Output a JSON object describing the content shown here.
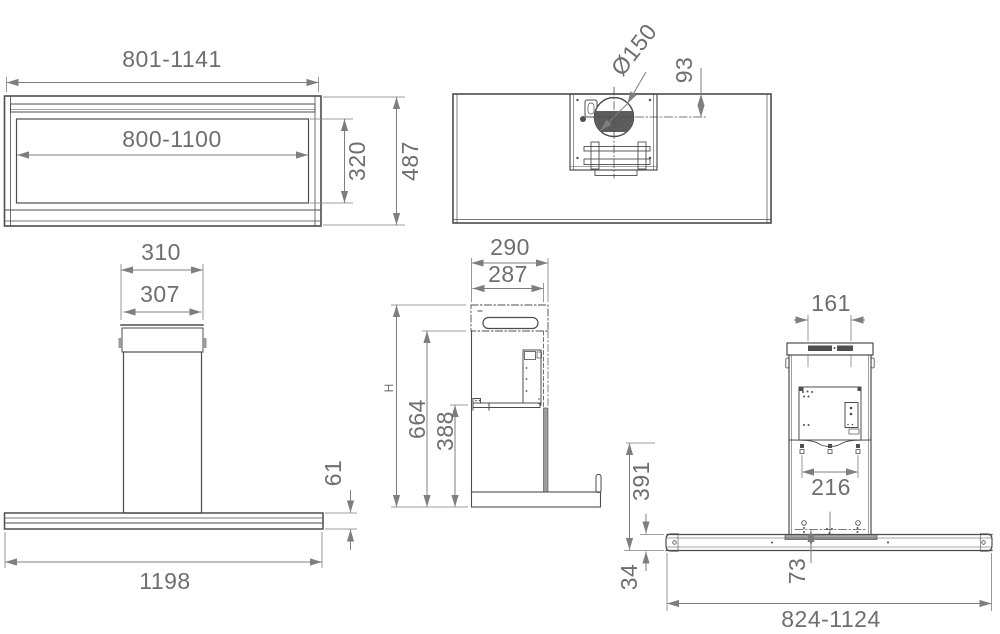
{
  "colors": {
    "object_line": "#4d4d4d",
    "dimension_line": "#7e7e7e",
    "text": "#6e6e6e",
    "dark_fill": "#4f4f4f",
    "gray_fill": "#a3a3a3"
  },
  "views": {
    "front_box": {
      "outer_width": "801-1141",
      "inner_width": "800-1100",
      "inner_height": "320",
      "total_height": "487"
    },
    "top": {
      "duct_diameter": "Ø150",
      "duct_offset": "93"
    },
    "front_island": {
      "chimney_top_width": "310",
      "chimney_body_width": "307",
      "canopy_thickness": "61",
      "canopy_width": "1198"
    },
    "side": {
      "depth": "290",
      "inner_depth": "287",
      "total_height_label": "H",
      "height_body": "664",
      "height_lower": "388"
    },
    "rear": {
      "slot_width": "161",
      "mount_width": "216",
      "mount_height": "391",
      "panel_thickness": "34",
      "hole_offset": "73",
      "base_width": "824-1124"
    }
  }
}
